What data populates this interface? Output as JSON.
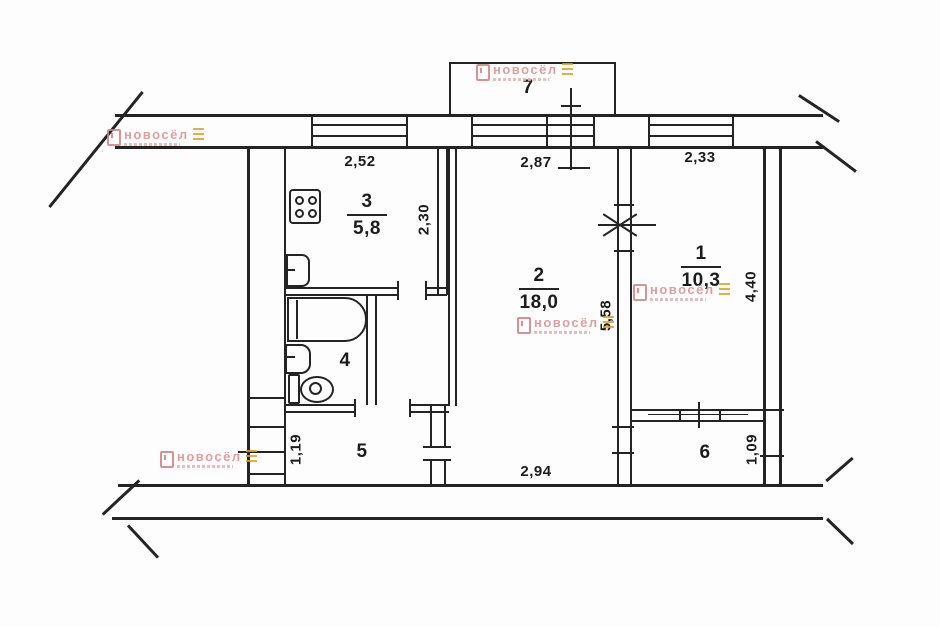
{
  "plan": {
    "rooms": {
      "r1": {
        "number": "1",
        "area": "10,3"
      },
      "r2": {
        "number": "2",
        "area": "18,0"
      },
      "r3": {
        "number": "3",
        "area": "5,8"
      },
      "r4": {
        "number": "4"
      },
      "r5": {
        "number": "5"
      },
      "r6": {
        "number": "6"
      },
      "r7": {
        "number": "7"
      }
    },
    "dimensions": {
      "kitchen_window_width": "2,52",
      "kitchen_depth": "2,30",
      "room2_window_width": "2,87",
      "room1_window_width": "2,33",
      "room2_depth": "5,58",
      "room1_depth": "4,40",
      "room2_bottom_width": "2,94",
      "hall_depth": "1,19",
      "balcony6_depth": "1,09"
    }
  },
  "watermark": {
    "text": "новосёл"
  },
  "colors": {
    "line": "#242424",
    "watermark_pink": "#d98f8f",
    "watermark_orange": "#dfa125"
  }
}
